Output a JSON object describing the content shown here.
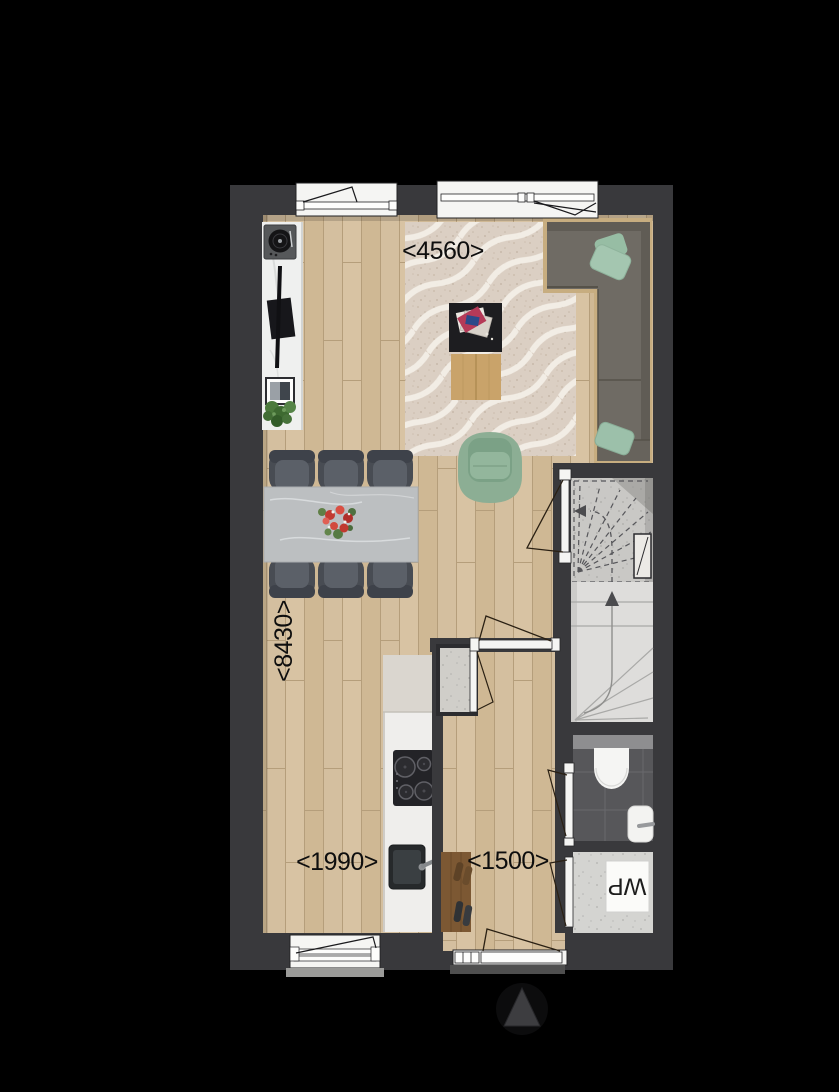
{
  "plan": {
    "labels": {
      "dim_living_width": "<4560>",
      "dim_house_depth": "<8430>",
      "dim_kitchen_width": "<1990>",
      "dim_hall_width": "<1500>",
      "heat_pump": "WP"
    },
    "colors": {
      "background": "#000000",
      "wall": "#39393c",
      "wood_floor": "#d3bd9c",
      "rug": "#dbcfc3",
      "sofa": "#6f6b64",
      "sofa_platform": "#c7ad80",
      "pillow_green": "#9cc0aa",
      "armchair_green": "#8cae94",
      "dining_table": "#bcbfc1",
      "dining_chair": "#484c53",
      "flowers_red": "#c23b32",
      "stair_tread": "#dedddb",
      "stair_upper": "#c9c8c5",
      "toilet_tile": "#57575a",
      "kitchen_counter": "#efeeec",
      "coat_rack": "#7c5833",
      "door_window_white": "#f5f5f3",
      "swing_line": "#2a2013",
      "dimension_text": "#0e0e0e"
    },
    "icons": {
      "north_arrow": "triangle-up",
      "hob": "induction-hob-4-burners",
      "sink": "kitchen-sink-with-tap",
      "toilet": "wall-hung-toilet",
      "basin": "hand-basin",
      "turntable": "record-player",
      "tv": "flat-tv-with-soundbar",
      "plant": "green-plant",
      "stairs": "winder-staircase-up"
    }
  }
}
